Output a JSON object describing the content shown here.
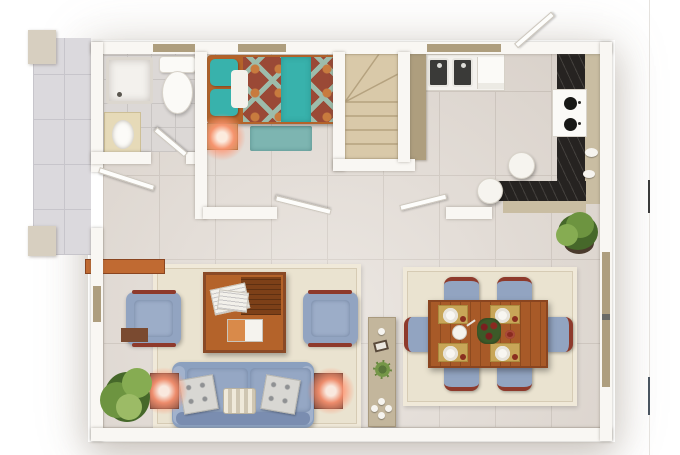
{
  "scene": {
    "type": "apartment-floor-plan-3d-render",
    "view": "top-down",
    "visible_text": "none"
  },
  "palette": {
    "wall": "#f9f7f3",
    "floor": "#e3dcd5",
    "floor_grout": "#cfc7bf",
    "bath_floor": "#dcd8d6",
    "terrace": "#dbd9dd",
    "terrace_grout": "#c7c5cb",
    "tan": "#ae9e7e",
    "stairs": "#d9c9a9",
    "stair_line": "#b5a27f",
    "marble": "#262321",
    "beige_cab": "#c9bda2",
    "wood": "#b4632a",
    "wood_dark": "#7d4018",
    "teal": "#38b2ac",
    "bed_red": "#9a4936",
    "bed_sage": "#9dbcab",
    "bed_orange": "#c87b3e",
    "blue": "#92a4c1",
    "chair_wood": "#8e3a2c",
    "rug": "#eae3d0",
    "rug_line": "#d6cbb4",
    "console": "#c3b69c",
    "glow": "#ff9673",
    "plant": "#6d9440",
    "plant_dark": "#46682a"
  },
  "rooms": [
    {
      "name": "bathroom",
      "position": "top-left",
      "furniture": [
        "shower-tray",
        "toilet",
        "sink-vanity"
      ],
      "door": "hinged-bottom"
    },
    {
      "name": "bedroom",
      "position": "top-center",
      "furniture": [
        "double-bed-patterned-blanket",
        "teal-pillows",
        "nightstand-with-lit-lamp",
        "teal-rug"
      ],
      "door": "hinged-bottom"
    },
    {
      "name": "staircase",
      "position": "center",
      "furniture": [
        "winder-stairs"
      ],
      "treads": 4
    },
    {
      "name": "kitchen",
      "position": "top-right",
      "furniture": [
        "double-sink",
        "side-counter",
        "gas-stove-4-burners",
        "l-shaped-black-marble-counter",
        "stool",
        "stool"
      ],
      "doors": [
        "bottom-hinged",
        "top-exit-hinged"
      ]
    },
    {
      "name": "living-room",
      "position": "bottom-left",
      "furniture": [
        "three-seat-sofa",
        "armchair",
        "armchair",
        "coffee-table-with-magazines",
        "tv-console",
        "lamp-table",
        "lamp-table",
        "floor-plant",
        "cream-rug",
        "side-shelf"
      ]
    },
    {
      "name": "dining-room",
      "position": "bottom-right",
      "furniture": [
        "wood-dining-table",
        "six-chairs",
        "four-place-settings",
        "flower-centerpiece",
        "cream-rug",
        "corner-plant"
      ]
    },
    {
      "name": "terrace",
      "position": "left-outside",
      "furniture": [
        "pillar",
        "pillar"
      ],
      "door": "terrace-door"
    }
  ],
  "counts": {
    "dining_chairs": 6,
    "place_settings": 4,
    "stove_burners": 2,
    "sofa_pillows": 3,
    "armchairs": 2,
    "kitchen_stools": 2,
    "doors": 5,
    "windows": 5,
    "plants": 3,
    "lit_lamps": 3
  }
}
